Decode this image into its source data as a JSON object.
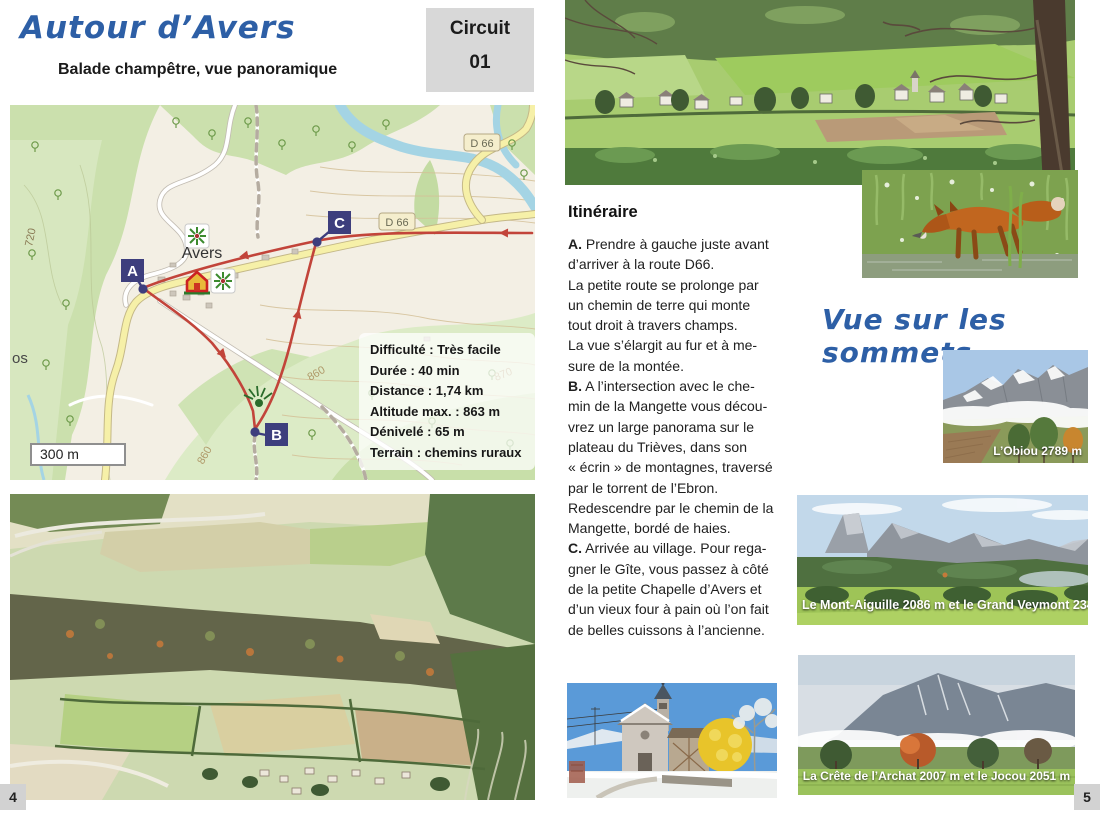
{
  "colors": {
    "accent_blue": "#2d5fa6",
    "badge_gray": "#d8d8d8",
    "marker_navy": "#3d3e7d",
    "route_red": "#c2443a"
  },
  "left_page": {
    "page_number": "4",
    "title": "Autour d’Avers",
    "subtitle": "Balade champêtre, vue panoramique",
    "circuit_badge": {
      "label": "Circuit",
      "number": "01"
    },
    "map": {
      "village_label": "Avers",
      "road_badge_top": "D 66",
      "road_badge_mid": "D 66",
      "marker_a": "A",
      "marker_b": "B",
      "marker_c": "C",
      "contour_720": "720",
      "contour_860a": "860",
      "contour_860b": "860",
      "contour_870": "870",
      "edge_label": "os",
      "scale_label": "300 m",
      "info_lines": [
        "Difficulté : Très facile",
        "Durée : 40 min",
        "Distance : 1,74 km",
        "Altitude max. : 863 m",
        "Dénivelé : 65 m",
        "Terrain : chemins ruraux"
      ]
    }
  },
  "right_page": {
    "page_number": "5",
    "itinerary": {
      "heading": "Itinéraire",
      "paragraphs": [
        {
          "lead": "A.",
          "text": " Prendre à gauche juste avant\nd’arriver à la route D66.\nLa petite route se prolonge par\nun chemin de terre qui monte\ntout droit à travers champs.\nLa vue s’élargit au fur et à  me-\nsure de la montée."
        },
        {
          "lead": "B.",
          "text": "  A l’intersection avec le che-\nmin de la Mangette vous décou-\nvrez un large panorama sur le\nplateau du Trièves, dans son\n« écrin » de montagnes, traversé\npar le torrent de l’Ebron.\nRedescendre par le chemin de la\nMangette, bordé de haies."
        },
        {
          "lead": "C.",
          "text": " Arrivée au village. Pour rega-\ngner le Gîte, vous passez à côté\nde la petite Chapelle d’Avers et\nd’un vieux four à pain où l’on fait\nde belles cuissons à l’ancienne."
        }
      ]
    },
    "summits_heading": "Vue sur les sommets",
    "photo_captions": {
      "obiou": "L’Obiou 2789 m",
      "mont_aiguille": "Le Mont-Aiguille 2086 m et le Grand Veymont 2341 m",
      "archat": "La Crête de l’Archat 2007 m  et le Jocou 2051 m"
    }
  }
}
